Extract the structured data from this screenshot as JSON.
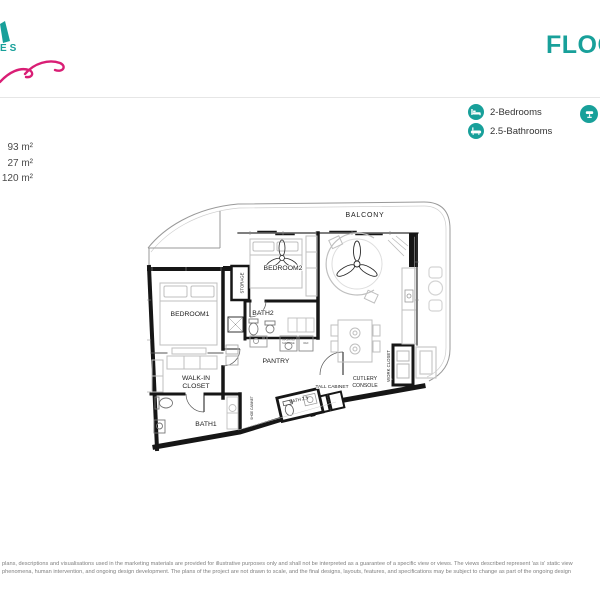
{
  "colors": {
    "brand_teal": "#18a09a",
    "brand_pink": "#d91e75",
    "wall_black": "#161616"
  },
  "header": {
    "title": "FLOO",
    "logo_fragment_text": "ES"
  },
  "legend": {
    "items": [
      {
        "icon": "bed-icon",
        "label": "2-Bedrooms"
      },
      {
        "icon": "bathtub-icon",
        "label": "2.5-Bathrooms"
      }
    ]
  },
  "areas": {
    "values": [
      "93 m²",
      "27 m²",
      "120 m²"
    ]
  },
  "plan": {
    "balcony": "BALCONY",
    "bedroom2": "BEDROOM2",
    "bedroom1": "BEDROOM1",
    "storage": "STORAGE",
    "bath2": "BATH2",
    "pantry": "PANTRY",
    "walk_in_closet_line1": "WALK-IN",
    "walk_in_closet_line2": "CLOSET",
    "bath1": "BATH1",
    "bath_2_5": "BATH 2.5",
    "tall_cabinet": "TALL CABINET",
    "cutlery_console_line1": "CUTLERY",
    "cutlery_console_line2": "CONSOLE",
    "work_closet": "WORK CLOSET",
    "shoe_cabinet": "SHOE CABINET",
    "washing_machine_line1": "WASHING",
    "washing_machine_line2": "MACHINE",
    "ref": "REF"
  },
  "footer": {
    "disclaimer_line1": "plans, descriptions and visualisations used in the marketing materials are provided for illustrative purposes only and shall not be interpreted as a guarantee of a specific view or views. The views described represent 'as is' static view",
    "disclaimer_line2": "phenomena, human intervention, and ongoing design development. The plans of the project are not drawn to scale, and the final designs, layouts, features, and specifications may be subject to change as part of the ongoing design"
  }
}
